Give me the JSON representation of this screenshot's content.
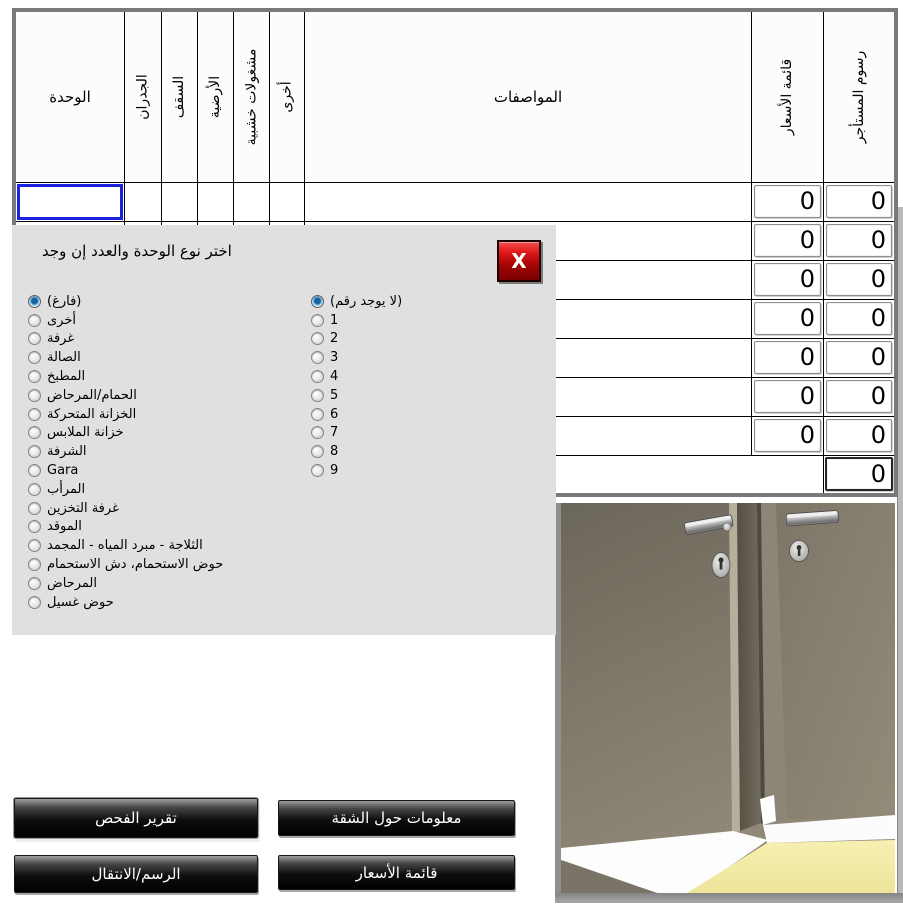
{
  "table": {
    "headers": [
      "الوحدة",
      "الجدران",
      "السقف",
      "الأرضية",
      "مشغولات خشبية",
      "أخرى",
      "المواصفات",
      "قائمة الأسعار",
      "رسوم المستأجر"
    ],
    "rows": [
      {
        "price_list": "0",
        "tenant_fees": "0"
      },
      {
        "price_list": "0",
        "tenant_fees": "0"
      },
      {
        "price_list": "0",
        "tenant_fees": "0"
      },
      {
        "price_list": "0",
        "tenant_fees": "0"
      },
      {
        "price_list": "0",
        "tenant_fees": "0"
      },
      {
        "price_list": "0",
        "tenant_fees": "0"
      },
      {
        "price_list": "0",
        "tenant_fees": "0"
      }
    ],
    "total_label": "الإجمالي",
    "total_tenant_fees": "0"
  },
  "dialog": {
    "title": "اختر نوع الوحدة والعدد إن وجد",
    "close_label": "X",
    "unit_options": [
      {
        "label": "(فارغ)",
        "selected": true
      },
      {
        "label": "أخرى",
        "selected": false
      },
      {
        "label": "غرفة",
        "selected": false
      },
      {
        "label": "الصالة",
        "selected": false
      },
      {
        "label": "المطبخ",
        "selected": false
      },
      {
        "label": "الحمام/المرحاض",
        "selected": false
      },
      {
        "label": "الخزانة المتحركة",
        "selected": false
      },
      {
        "label": "خزانة الملابس",
        "selected": false
      },
      {
        "label": "الشرفة",
        "selected": false
      },
      {
        "label": "Gara",
        "selected": false
      },
      {
        "label": "المرأب",
        "selected": false
      },
      {
        "label": "غرفة التخزين",
        "selected": false
      },
      {
        "label": "الموقد",
        "selected": false
      },
      {
        "label": "الثلاجة - مبرد المياه - المجمد",
        "selected": false
      },
      {
        "label": "حوض الاستحمام، دش الاستحمام",
        "selected": false
      },
      {
        "label": "المرحاض",
        "selected": false
      },
      {
        "label": "حوض غسيل",
        "selected": false
      }
    ],
    "number_options": [
      {
        "label": "(لا يوجد رقم)",
        "selected": true
      },
      {
        "label": "1",
        "selected": false
      },
      {
        "label": "2",
        "selected": false
      },
      {
        "label": "3",
        "selected": false
      },
      {
        "label": "4",
        "selected": false
      },
      {
        "label": "5",
        "selected": false
      },
      {
        "label": "6",
        "selected": false
      },
      {
        "label": "7",
        "selected": false
      },
      {
        "label": "8",
        "selected": false
      },
      {
        "label": "9",
        "selected": false
      }
    ]
  },
  "buttons": {
    "inspection_report": "تقرير الفحص",
    "apartment_info": "معلومات حول الشقة",
    "drawing_navigation": "الرسم/الانتقال",
    "price_list": "قائمة الأسعار"
  },
  "colors": {
    "dialog_bg": "#e0e0e0",
    "close_button_red": "#c40b0b",
    "focus_blue": "#1b22e0",
    "floor_yellow": "#f2eca8"
  }
}
